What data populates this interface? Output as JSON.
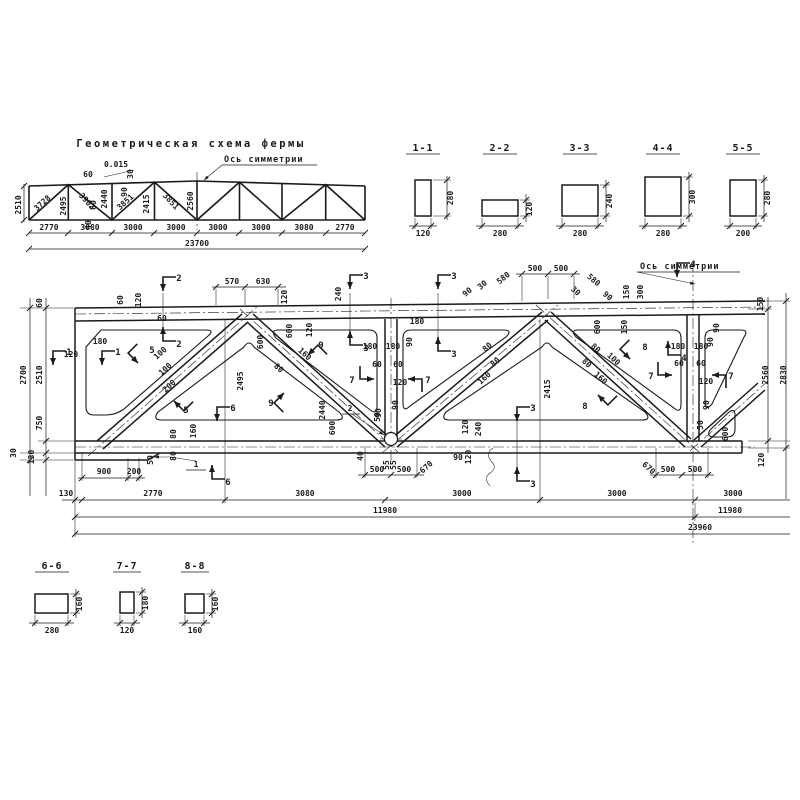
{
  "scheme": {
    "title": "Геометрическая схема фермы",
    "symmetry_label": "Ось симметрии",
    "total_label": "23700",
    "labels": [
      {
        "x": 2,
        "y": 69,
        "t": "2510",
        "r": -90
      },
      {
        "x": 25,
        "y": 69,
        "t": "3728",
        "r": -42
      },
      {
        "x": 47,
        "y": 70,
        "t": "2495",
        "r": -90
      },
      {
        "x": 66,
        "y": 67,
        "t": "3902",
        "r": 48
      },
      {
        "x": 88,
        "y": 63,
        "t": "2440",
        "r": -90
      },
      {
        "x": 108,
        "y": 68,
        "t": "3851",
        "r": -42
      },
      {
        "x": 130,
        "y": 68,
        "t": "2415",
        "r": -90
      },
      {
        "x": 150,
        "y": 67,
        "t": "3851",
        "r": 48
      },
      {
        "x": 174,
        "y": 65,
        "t": "2560",
        "r": -90
      },
      {
        "x": 97,
        "y": 31,
        "t": "0.015",
        "s": 7
      },
      {
        "x": 114,
        "y": 38,
        "t": "30",
        "r": -90,
        "s": 6.5
      },
      {
        "x": 108,
        "y": 56,
        "t": "90",
        "r": -90,
        "s": 6.5
      },
      {
        "x": 69,
        "y": 41,
        "t": "60",
        "s": 6.5
      },
      {
        "x": 77,
        "y": 69,
        "t": "60",
        "r": -90,
        "s": 6.5
      },
      {
        "x": 72,
        "y": 89,
        "t": "40",
        "r": -90,
        "s": 6.5
      },
      {
        "x": 30,
        "y": 94,
        "t": "2770",
        "s": 7
      },
      {
        "x": 71,
        "y": 94,
        "t": "3080",
        "s": 7
      },
      {
        "x": 114,
        "y": 94,
        "t": "3000",
        "s": 7
      },
      {
        "x": 157,
        "y": 94,
        "t": "3000",
        "s": 7
      },
      {
        "x": 199,
        "y": 94,
        "t": "3000",
        "s": 7
      },
      {
        "x": 242,
        "y": 94,
        "t": "3000",
        "s": 7
      },
      {
        "x": 285,
        "y": 94,
        "t": "3080",
        "s": 7
      },
      {
        "x": 326,
        "y": 94,
        "t": "2770",
        "s": 7
      },
      {
        "x": 178,
        "y": 110,
        "t": "23700"
      }
    ]
  },
  "sections_top": {
    "items": [
      {
        "id": "1-1",
        "w": "120",
        "h": "280"
      },
      {
        "id": "2-2",
        "w": "280",
        "h": "120"
      },
      {
        "id": "3-3",
        "w": "280",
        "h": "240"
      },
      {
        "id": "4-4",
        "w": "280",
        "h": "300"
      },
      {
        "id": "5-5",
        "w": "200",
        "h": "280"
      }
    ]
  },
  "sections_bottom": {
    "items": [
      {
        "id": "6-6",
        "w": "280",
        "h": "160"
      },
      {
        "id": "7-7",
        "w": "120",
        "h": "180"
      },
      {
        "id": "8-8",
        "w": "160",
        "h": "160"
      }
    ]
  },
  "main": {
    "symmetry_label": "Ось симметрии",
    "labels": [
      {
        "x": 232,
        "y": 31,
        "t": "570"
      },
      {
        "x": 263,
        "y": 31,
        "t": "630"
      },
      {
        "x": 535,
        "y": 18,
        "t": "500"
      },
      {
        "x": 561,
        "y": 18,
        "t": "500"
      },
      {
        "x": 505,
        "y": 27,
        "t": "580",
        "r": -40
      },
      {
        "x": 469,
        "y": 41,
        "t": "90",
        "r": -40,
        "s": 6.5
      },
      {
        "x": 484,
        "y": 34,
        "t": "30",
        "r": -40,
        "s": 6.5
      },
      {
        "x": 592,
        "y": 29,
        "t": "580",
        "r": 40
      },
      {
        "x": 574,
        "y": 40,
        "t": "30",
        "r": 40,
        "s": 6.5
      },
      {
        "x": 606,
        "y": 45,
        "t": "90",
        "r": 40,
        "s": 6.5
      },
      {
        "x": 629,
        "y": 39,
        "t": "150",
        "r": -90,
        "s": 7
      },
      {
        "x": 643,
        "y": 39,
        "t": "300",
        "r": -90,
        "s": 7
      },
      {
        "x": 627,
        "y": 74,
        "t": "150",
        "r": -90,
        "s": 7
      },
      {
        "x": 763,
        "y": 51,
        "t": "150",
        "r": -90,
        "s": 7
      },
      {
        "x": 123,
        "y": 47,
        "t": "60",
        "r": -90,
        "s": 7
      },
      {
        "x": 141,
        "y": 47,
        "t": "120",
        "r": -90,
        "s": 7
      },
      {
        "x": 287,
        "y": 44,
        "t": "120",
        "r": -90,
        "s": 7
      },
      {
        "x": 341,
        "y": 41,
        "t": "240",
        "r": -90,
        "s": 7
      },
      {
        "x": 312,
        "y": 77,
        "t": "120",
        "r": -90,
        "s": 7
      },
      {
        "x": 292,
        "y": 78,
        "t": "600",
        "r": -90,
        "s": 7
      },
      {
        "x": 600,
        "y": 74,
        "t": "600",
        "r": -90,
        "s": 7
      },
      {
        "x": 26,
        "y": 122,
        "t": "2700",
        "r": -90
      },
      {
        "x": 42,
        "y": 122,
        "t": "2510",
        "r": -90
      },
      {
        "x": 42,
        "y": 50,
        "t": "60",
        "r": -90,
        "s": 7
      },
      {
        "x": 42,
        "y": 170,
        "t": "750",
        "r": -90,
        "s": 7
      },
      {
        "x": 34,
        "y": 204,
        "t": "130",
        "r": -90,
        "s": 7
      },
      {
        "x": 16,
        "y": 200,
        "t": "30",
        "r": -90,
        "s": 6.5
      },
      {
        "x": 100,
        "y": 91,
        "t": "180",
        "s": 7
      },
      {
        "x": 71,
        "y": 104,
        "t": "120",
        "s": 7
      },
      {
        "x": 768,
        "y": 122,
        "t": "2560",
        "r": -90
      },
      {
        "x": 786,
        "y": 122,
        "t": "2830",
        "r": -90
      },
      {
        "x": 764,
        "y": 207,
        "t": "120",
        "r": -90,
        "s": 7
      },
      {
        "x": 243,
        "y": 128,
        "t": "2495",
        "r": -90
      },
      {
        "x": 325,
        "y": 157,
        "t": "2440",
        "r": -90
      },
      {
        "x": 550,
        "y": 136,
        "t": "2415",
        "r": -90
      },
      {
        "x": 162,
        "y": 102,
        "t": "100",
        "r": -42,
        "s": 6.5
      },
      {
        "x": 167,
        "y": 118,
        "t": "100",
        "r": -42,
        "s": 6.5
      },
      {
        "x": 171,
        "y": 135,
        "t": "200",
        "r": -42,
        "s": 6.5
      },
      {
        "x": 277,
        "y": 117,
        "t": "80",
        "r": 42,
        "s": 6.5
      },
      {
        "x": 303,
        "y": 103,
        "t": "160",
        "r": 42,
        "s": 6.5
      },
      {
        "x": 263,
        "y": 89,
        "t": "600",
        "r": -90,
        "s": 6.5
      },
      {
        "x": 489,
        "y": 96,
        "t": "80",
        "r": -42,
        "s": 6.5
      },
      {
        "x": 497,
        "y": 111,
        "t": "80",
        "r": -42,
        "s": 6.5
      },
      {
        "x": 486,
        "y": 127,
        "t": "160",
        "r": -42,
        "s": 6.5
      },
      {
        "x": 585,
        "y": 112,
        "t": "80",
        "r": 42,
        "s": 6.5
      },
      {
        "x": 594,
        "y": 97,
        "t": "80",
        "r": 42,
        "s": 6.5
      },
      {
        "x": 599,
        "y": 127,
        "t": "160",
        "r": 42,
        "s": 6.5
      },
      {
        "x": 612,
        "y": 108,
        "t": "100",
        "r": 42,
        "s": 6.5
      },
      {
        "x": 370,
        "y": 96,
        "t": "180",
        "s": 6
      },
      {
        "x": 393,
        "y": 96,
        "t": "180",
        "s": 6
      },
      {
        "x": 412,
        "y": 89,
        "t": "90",
        "r": -90,
        "s": 6
      },
      {
        "x": 377,
        "y": 114,
        "t": "60",
        "s": 6
      },
      {
        "x": 398,
        "y": 114,
        "t": "60",
        "s": 6
      },
      {
        "x": 400,
        "y": 132,
        "t": "120",
        "s": 6.5
      },
      {
        "x": 398,
        "y": 152,
        "t": "90",
        "r": -90,
        "s": 6
      },
      {
        "x": 380,
        "y": 164,
        "t": "50",
        "r": -90,
        "s": 6
      },
      {
        "x": 417,
        "y": 71,
        "t": "180",
        "s": 6
      },
      {
        "x": 678,
        "y": 96,
        "t": "180",
        "s": 6
      },
      {
        "x": 701,
        "y": 96,
        "t": "180",
        "s": 6
      },
      {
        "x": 713,
        "y": 89,
        "t": "90",
        "r": -90,
        "s": 6
      },
      {
        "x": 719,
        "y": 75,
        "t": "90",
        "r": -90,
        "s": 6
      },
      {
        "x": 679,
        "y": 113,
        "t": "60",
        "s": 6
      },
      {
        "x": 701,
        "y": 113,
        "t": "60",
        "s": 6
      },
      {
        "x": 706,
        "y": 131,
        "t": "120",
        "s": 6.5
      },
      {
        "x": 709,
        "y": 152,
        "t": "90",
        "r": -90,
        "s": 6
      },
      {
        "x": 703,
        "y": 172,
        "t": "50",
        "r": -90,
        "s": 6
      },
      {
        "x": 728,
        "y": 181,
        "t": "600",
        "r": -90,
        "s": 6.5
      },
      {
        "x": 104,
        "y": 221,
        "t": "900",
        "s": 7
      },
      {
        "x": 134,
        "y": 221,
        "t": "200",
        "s": 6
      },
      {
        "x": 153,
        "y": 207,
        "t": "50",
        "r": -90,
        "s": 6
      },
      {
        "x": 176,
        "y": 203,
        "t": "80",
        "r": -90,
        "s": 6
      },
      {
        "x": 176,
        "y": 181,
        "t": "80",
        "r": -90,
        "s": 6
      },
      {
        "x": 196,
        "y": 178,
        "t": "160",
        "r": -90,
        "s": 6
      },
      {
        "x": 66,
        "y": 243,
        "t": "130",
        "s": 7
      },
      {
        "x": 153,
        "y": 243,
        "t": "2770"
      },
      {
        "x": 305,
        "y": 243,
        "t": "3080"
      },
      {
        "x": 462,
        "y": 243,
        "t": "3000"
      },
      {
        "x": 617,
        "y": 243,
        "t": "3000"
      },
      {
        "x": 733,
        "y": 243,
        "t": "3000"
      },
      {
        "x": 385,
        "y": 260,
        "t": "11980"
      },
      {
        "x": 730,
        "y": 260,
        "t": "11980"
      },
      {
        "x": 700,
        "y": 277,
        "t": "23960"
      },
      {
        "x": 377,
        "y": 219,
        "t": "500",
        "s": 7
      },
      {
        "x": 404,
        "y": 219,
        "t": "500",
        "s": 7
      },
      {
        "x": 668,
        "y": 219,
        "t": "500",
        "s": 7
      },
      {
        "x": 695,
        "y": 219,
        "t": "500",
        "s": 7
      },
      {
        "x": 428,
        "y": 216,
        "t": "670",
        "r": -42,
        "s": 7
      },
      {
        "x": 647,
        "y": 217,
        "t": "670",
        "r": 42,
        "s": 7
      },
      {
        "x": 458,
        "y": 207,
        "t": "90",
        "s": 6.5
      },
      {
        "x": 363,
        "y": 203,
        "t": "40",
        "r": -90,
        "s": 6
      },
      {
        "x": 389,
        "y": 212,
        "t": "55",
        "r": -90,
        "s": 5.5
      },
      {
        "x": 396,
        "y": 212,
        "t": "55",
        "r": -90,
        "s": 5.5
      },
      {
        "x": 468,
        "y": 174,
        "t": "120",
        "r": -90,
        "s": 6
      },
      {
        "x": 481,
        "y": 176,
        "t": "240",
        "r": -90,
        "s": 6
      },
      {
        "x": 471,
        "y": 204,
        "t": "120",
        "r": -90,
        "s": 6
      },
      {
        "x": 335,
        "y": 175,
        "t": "600",
        "r": -90,
        "s": 6.5
      },
      {
        "x": 381,
        "y": 160,
        "t": "90",
        "r": -90,
        "s": 6
      },
      {
        "x": 162,
        "y": 68,
        "t": "60",
        "s": 6
      },
      {
        "x": 196,
        "y": 214,
        "t": "1",
        "s": 9
      },
      {
        "x": 350,
        "y": 158,
        "t": "2",
        "s": 9
      }
    ],
    "markers": [
      {
        "x": 163,
        "y": 38,
        "k": "d",
        "t": "2"
      },
      {
        "x": 163,
        "y": 74,
        "k": "u",
        "t": "2"
      },
      {
        "x": 350,
        "y": 36,
        "k": "d",
        "t": "3"
      },
      {
        "x": 350,
        "y": 78,
        "k": "u",
        "t": "3"
      },
      {
        "x": 438,
        "y": 36,
        "k": "d",
        "t": "3"
      },
      {
        "x": 438,
        "y": 84,
        "k": "u",
        "t": "3"
      },
      {
        "x": 517,
        "y": 168,
        "k": "d",
        "t": "3"
      },
      {
        "x": 517,
        "y": 214,
        "k": "u",
        "t": "3"
      },
      {
        "x": 677,
        "y": 24,
        "k": "d",
        "t": "4"
      },
      {
        "x": 668,
        "y": 88,
        "k": "u",
        "t": "4"
      },
      {
        "x": 53,
        "y": 112,
        "k": "d",
        "t": "1"
      },
      {
        "x": 102,
        "y": 112,
        "k": "d",
        "t": "1"
      },
      {
        "x": 138,
        "y": 110,
        "r": -45,
        "k": "d",
        "t": "5",
        "tx": 152,
        "ty": 100
      },
      {
        "x": 174,
        "y": 148,
        "r": -45,
        "k": "u",
        "t": "5",
        "tx": 186,
        "ty": 160
      },
      {
        "x": 217,
        "y": 168,
        "k": "d",
        "t": "6"
      },
      {
        "x": 212,
        "y": 212,
        "k": "u",
        "t": "6"
      },
      {
        "x": 374,
        "y": 126,
        "r": -90,
        "k": "d",
        "t": "7",
        "tx": 352,
        "ty": 130
      },
      {
        "x": 408,
        "y": 126,
        "r": 90,
        "k": "d",
        "t": "7",
        "tx": 428,
        "ty": 130
      },
      {
        "x": 672,
        "y": 122,
        "r": -90,
        "k": "d",
        "t": "7",
        "tx": 651,
        "ty": 126
      },
      {
        "x": 712,
        "y": 122,
        "r": 90,
        "k": "d",
        "t": "7",
        "tx": 731,
        "ty": 126
      },
      {
        "x": 630,
        "y": 106,
        "r": -45,
        "k": "d",
        "t": "8",
        "tx": 645,
        "ty": 97
      },
      {
        "x": 598,
        "y": 142,
        "r": -45,
        "k": "u",
        "t": "8",
        "tx": 585,
        "ty": 156
      },
      {
        "x": 308,
        "y": 102,
        "r": 45,
        "k": "d",
        "t": "9",
        "tx": 321,
        "ty": 95
      },
      {
        "x": 284,
        "y": 140,
        "r": 45,
        "k": "u",
        "t": "9",
        "tx": 271,
        "ty": 153
      }
    ]
  }
}
